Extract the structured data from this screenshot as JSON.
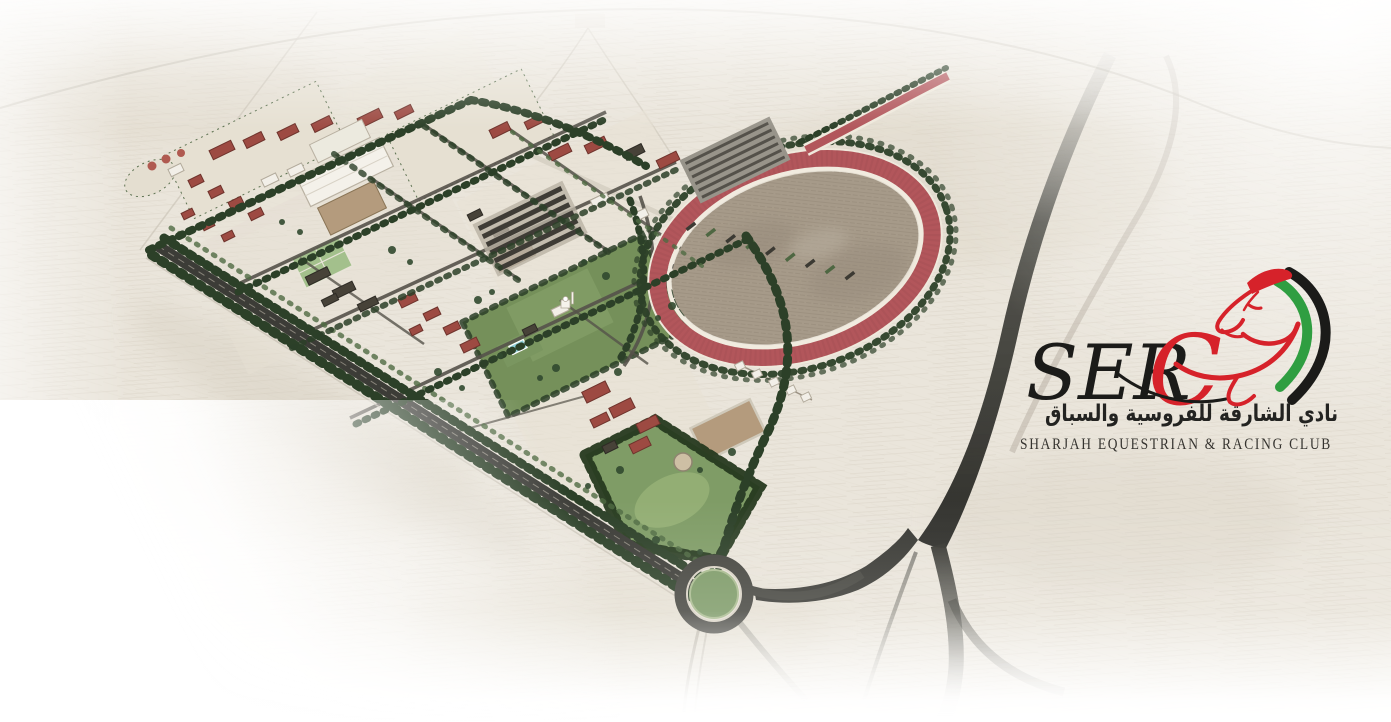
{
  "logo": {
    "acronym": {
      "black": "SER",
      "red": "C"
    },
    "arabic_name": "نادي الشارقة للفروسية والسباق",
    "english_name": "SHARJAH EQUESTRIAN & RACING CLUB",
    "colors": {
      "logo_red": "#d6222a",
      "flag_green": "#2f9e41",
      "flag_black": "#1c1c1a",
      "flag_white": "#ffffff"
    }
  },
  "scene": {
    "type": "aerial-master-plan-rendering",
    "palette": {
      "paper": "#eae5db",
      "racetrack_red": "#b2565b",
      "infield_sand": "#a69a89",
      "foliage_dark": "#2c4028",
      "lawn_green": "#75905a",
      "asphalt_dark": "#3c3c36",
      "roof_red": "#9d4a42"
    },
    "features": [
      "racetrack-oval",
      "training-track",
      "stables-block",
      "indoor-arena",
      "riding-arenas",
      "paddocks",
      "sports-courts",
      "swimming-pool",
      "tree-lined-boulevard",
      "roundabout",
      "access-highway",
      "south-parkland",
      "staff-housing",
      "parking-area",
      "desert-terrain"
    ]
  }
}
